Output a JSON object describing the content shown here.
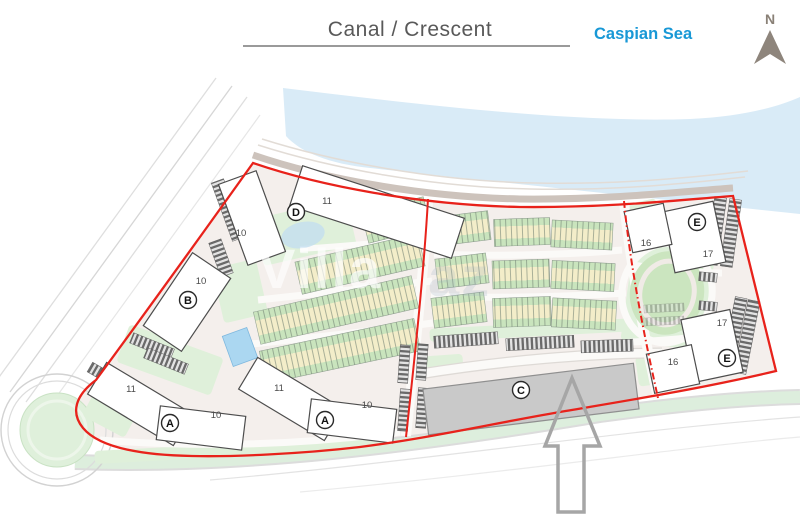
{
  "header": {
    "title": "Canal / Crescent",
    "sea_label": "Caspian Sea",
    "north_label": "N"
  },
  "watermark": {
    "primary": "Villa",
    "secondary": "az"
  },
  "colors": {
    "boundary_red": "#e8221b",
    "water_blue": "#d9ebf7",
    "lawn_green": "#dff0da",
    "unit_green": "#c9e4bd",
    "unit_yellow": "#f3edc9",
    "building_c_gray": "#c9c9c9",
    "sea_label_blue": "#1898d6"
  },
  "markers": [
    {
      "letter": "D",
      "x": 296,
      "y": 212
    },
    {
      "letter": "B",
      "x": 188,
      "y": 300
    },
    {
      "letter": "A",
      "x": 170,
      "y": 423
    },
    {
      "letter": "A",
      "x": 325,
      "y": 420
    },
    {
      "letter": "C",
      "x": 521,
      "y": 390
    },
    {
      "letter": "E",
      "x": 697,
      "y": 222
    },
    {
      "letter": "E",
      "x": 727,
      "y": 358
    }
  ],
  "unit_numbers": [
    {
      "text": "11",
      "x": 327,
      "y": 204
    },
    {
      "text": "10",
      "x": 241,
      "y": 236
    },
    {
      "text": "10",
      "x": 201,
      "y": 284
    },
    {
      "text": "11",
      "x": 131,
      "y": 392
    },
    {
      "text": "10",
      "x": 216,
      "y": 418
    },
    {
      "text": "11",
      "x": 279,
      "y": 391
    },
    {
      "text": "10",
      "x": 367,
      "y": 408
    },
    {
      "text": "16",
      "x": 646,
      "y": 246
    },
    {
      "text": "17",
      "x": 708,
      "y": 257
    },
    {
      "text": "17",
      "x": 722,
      "y": 326
    },
    {
      "text": "16",
      "x": 673,
      "y": 365
    }
  ],
  "buildings": [
    {
      "name": "d-wing-main",
      "x": 377,
      "y": 212,
      "w": 170,
      "h": 42,
      "rot": 18
    },
    {
      "name": "d-wing-side",
      "x": 252,
      "y": 218,
      "w": 40,
      "h": 86,
      "rot": -20
    },
    {
      "name": "b-block",
      "x": 187,
      "y": 302,
      "w": 46,
      "h": 88,
      "rot": 34
    },
    {
      "name": "a1-wing-left",
      "x": 140,
      "y": 404,
      "w": 100,
      "h": 37,
      "rot": 31
    },
    {
      "name": "a1-wing-right",
      "x": 201,
      "y": 428,
      "w": 86,
      "h": 34,
      "rot": 7
    },
    {
      "name": "a2-wing-left",
      "x": 291,
      "y": 399,
      "w": 100,
      "h": 37,
      "rot": 31
    },
    {
      "name": "a2-wing-right",
      "x": 352,
      "y": 421,
      "w": 86,
      "h": 34,
      "rot": 7
    },
    {
      "name": "c-block",
      "x": 531,
      "y": 399,
      "w": 212,
      "h": 46,
      "rot": -7,
      "fill": "#c9c9c9",
      "stroke": "#8f8f8f"
    },
    {
      "name": "e1-main",
      "x": 694,
      "y": 237,
      "w": 52,
      "h": 62,
      "rot": -12
    },
    {
      "name": "e1-side",
      "x": 648,
      "y": 228,
      "w": 40,
      "h": 42,
      "rot": -12
    },
    {
      "name": "e2-main",
      "x": 712,
      "y": 346,
      "w": 50,
      "h": 64,
      "rot": -12
    },
    {
      "name": "e2-side",
      "x": 673,
      "y": 369,
      "w": 46,
      "h": 40,
      "rot": -12
    }
  ],
  "townhouse_strips": [
    {
      "x": 396,
      "y": 220,
      "w": 64,
      "h": 32,
      "rot": -14
    },
    {
      "x": 360,
      "y": 264,
      "w": 126,
      "h": 33,
      "rot": -13
    },
    {
      "x": 336,
      "y": 310,
      "w": 162,
      "h": 33,
      "rot": -13
    },
    {
      "x": 340,
      "y": 351,
      "w": 158,
      "h": 33,
      "rot": -12
    },
    {
      "x": 466,
      "y": 228,
      "w": 47,
      "h": 29,
      "rot": -7
    },
    {
      "x": 522,
      "y": 232,
      "w": 56,
      "h": 27,
      "rot": -2
    },
    {
      "x": 582,
      "y": 235,
      "w": 61,
      "h": 27,
      "rot": 3
    },
    {
      "x": 462,
      "y": 271,
      "w": 51,
      "h": 30,
      "rot": -7
    },
    {
      "x": 521,
      "y": 274,
      "w": 57,
      "h": 28,
      "rot": -2
    },
    {
      "x": 583,
      "y": 276,
      "w": 63,
      "h": 28,
      "rot": 3
    },
    {
      "x": 459,
      "y": 310,
      "w": 53,
      "h": 30,
      "rot": -7
    },
    {
      "x": 522,
      "y": 312,
      "w": 58,
      "h": 29,
      "rot": -2
    },
    {
      "x": 584,
      "y": 314,
      "w": 64,
      "h": 29,
      "rot": 3
    }
  ],
  "parking_strips": [
    {
      "x": 228,
      "y": 210,
      "w": 13,
      "h": 62,
      "rot": -20
    },
    {
      "x": 221,
      "y": 258,
      "w": 13,
      "h": 36,
      "rot": -20
    },
    {
      "x": 152,
      "y": 346,
      "w": 44,
      "h": 11,
      "rot": 22
    },
    {
      "x": 166,
      "y": 361,
      "w": 44,
      "h": 11,
      "rot": 22
    },
    {
      "x": 102,
      "y": 374,
      "w": 28,
      "h": 11,
      "rot": 30
    },
    {
      "x": 466,
      "y": 340,
      "w": 64,
      "h": 12,
      "rot": -4
    },
    {
      "x": 540,
      "y": 343,
      "w": 68,
      "h": 12,
      "rot": -3
    },
    {
      "x": 607,
      "y": 346,
      "w": 52,
      "h": 12,
      "rot": -2
    },
    {
      "x": 404,
      "y": 364,
      "w": 10,
      "h": 38,
      "rot": 4
    },
    {
      "x": 404,
      "y": 410,
      "w": 10,
      "h": 42,
      "rot": 4
    },
    {
      "x": 422,
      "y": 362,
      "w": 10,
      "h": 36,
      "rot": 4
    },
    {
      "x": 422,
      "y": 408,
      "w": 10,
      "h": 40,
      "rot": 4
    },
    {
      "x": 716,
      "y": 231,
      "w": 12,
      "h": 68,
      "rot": 8
    },
    {
      "x": 731,
      "y": 233,
      "w": 12,
      "h": 68,
      "rot": 8
    },
    {
      "x": 734,
      "y": 335,
      "w": 12,
      "h": 76,
      "rot": 11
    },
    {
      "x": 747,
      "y": 337,
      "w": 12,
      "h": 74,
      "rot": 11
    },
    {
      "x": 708,
      "y": 277,
      "w": 18,
      "h": 9,
      "rot": 5
    },
    {
      "x": 708,
      "y": 306,
      "w": 18,
      "h": 9,
      "rot": 5
    },
    {
      "x": 664,
      "y": 308,
      "w": 40,
      "h": 8,
      "rot": -3,
      "light": true
    },
    {
      "x": 664,
      "y": 321,
      "w": 40,
      "h": 8,
      "rot": -3,
      "light": true
    }
  ],
  "lawns": [
    {
      "x": 305,
      "y": 232,
      "w": 95,
      "h": 48,
      "rot": -13
    },
    {
      "x": 352,
      "y": 210,
      "w": 30,
      "h": 30,
      "rot": -14
    },
    {
      "x": 240,
      "y": 291,
      "w": 45,
      "h": 56,
      "rot": -13
    },
    {
      "x": 170,
      "y": 360,
      "w": 100,
      "h": 40,
      "rot": 20
    },
    {
      "x": 112,
      "y": 410,
      "w": 48,
      "h": 38,
      "rot": 28
    },
    {
      "x": 237,
      "y": 450,
      "w": 285,
      "h": 13,
      "rot": -3
    },
    {
      "x": 532,
      "y": 330,
      "w": 205,
      "h": 13,
      "rot": -3
    },
    {
      "x": 444,
      "y": 364,
      "w": 38,
      "h": 18,
      "rot": -4
    },
    {
      "x": 650,
      "y": 370,
      "w": 26,
      "h": 30,
      "rot": -8
    },
    {
      "x": 668,
      "y": 296,
      "w": 82,
      "h": 100,
      "rot": 8
    },
    {
      "x": 645,
      "y": 225,
      "w": 32,
      "h": 48,
      "rot": -12
    }
  ]
}
